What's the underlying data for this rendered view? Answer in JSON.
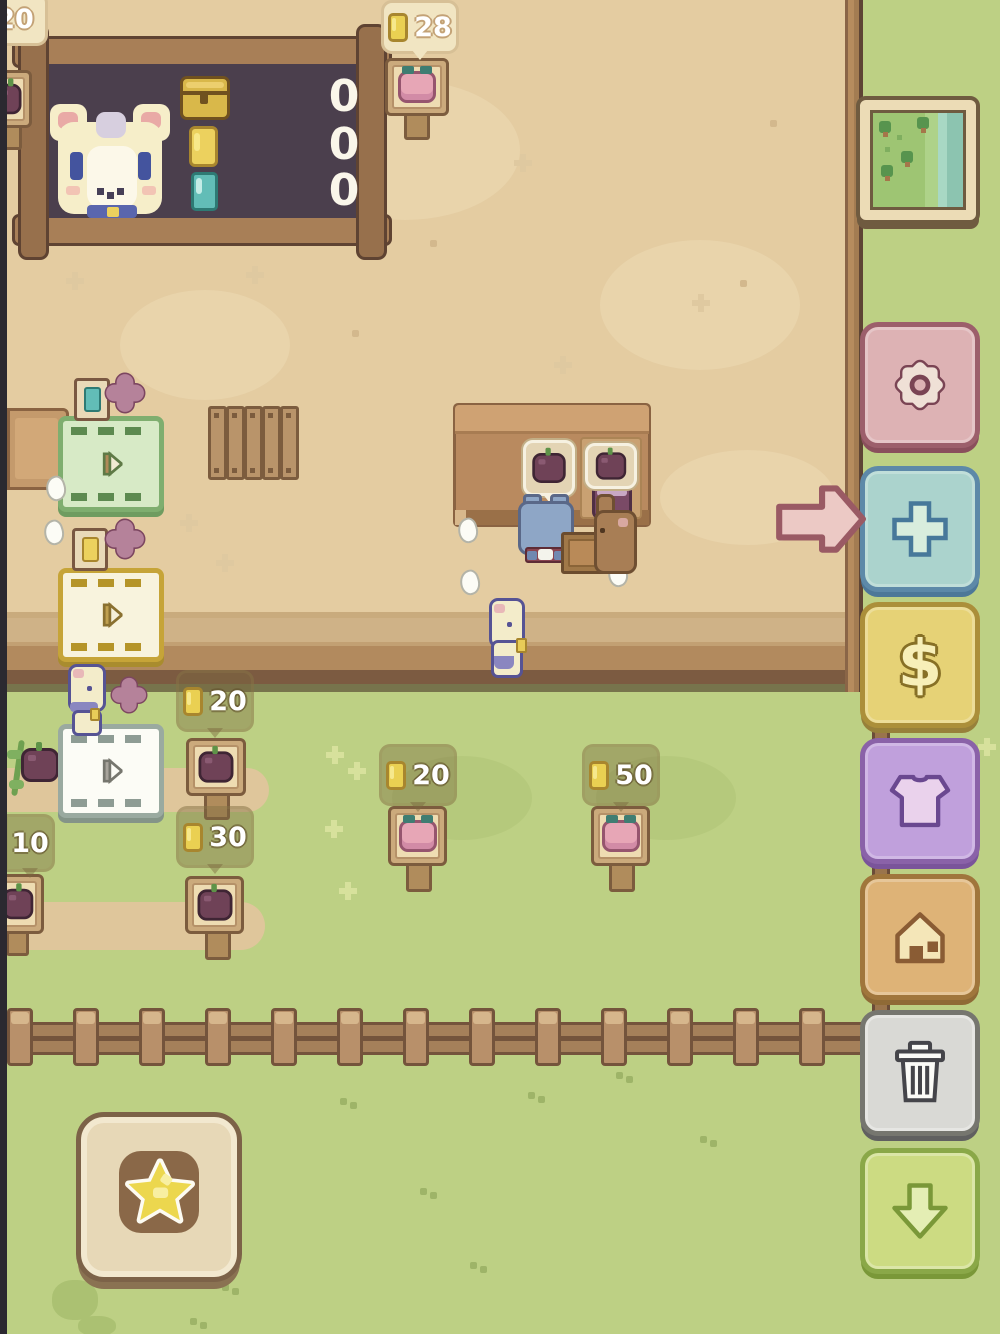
{
  "palette": {
    "grass": "#bdd084",
    "ground": "#e4cca1",
    "wood_band_dark": "#7c5b41",
    "board_bg": "#4b3f4d",
    "settings_pink": "#ddb2b4",
    "add_blue": "#abd3cd",
    "money_yellow": "#e6d276",
    "outfit_purple": "#c0a0dc",
    "home_orange": "#deb377",
    "trash_gray": "#d9d9d5",
    "hide_green": "#ccdb82",
    "pointer_pink": "#ecc9c5",
    "coin_gold": "#ecd15e",
    "gem_teal": "#62bdb7",
    "apple_plum": "#6f4257",
    "peach_pink": "#e7a6b6"
  },
  "scoreboard": {
    "rows": [
      {
        "icon": "treasure-chest-icon",
        "value": "0"
      },
      {
        "icon": "coin-icon",
        "value": "0"
      },
      {
        "icon": "gem-icon",
        "value": "0"
      }
    ]
  },
  "price_tags": {
    "corner": {
      "value": "20"
    },
    "stand_top": {
      "value": "28"
    },
    "belt": {
      "value": "20"
    },
    "field_left": {
      "value": "10"
    },
    "field_mid": {
      "value": "30"
    },
    "grass_left": {
      "value": "20"
    },
    "grass_right": {
      "value": "50"
    }
  },
  "sidebar": {
    "dollar_symbol": "$",
    "buttons": [
      {
        "id": "map",
        "icon": "map-icon"
      },
      {
        "id": "settings",
        "icon": "gear-icon"
      },
      {
        "id": "add",
        "icon": "plus-icon"
      },
      {
        "id": "money",
        "icon": "dollar-icon"
      },
      {
        "id": "outfit",
        "icon": "shirt-icon"
      },
      {
        "id": "home",
        "icon": "house-icon"
      },
      {
        "id": "trash",
        "icon": "trash-icon"
      },
      {
        "id": "hide-ui",
        "icon": "down-arrow-icon"
      }
    ]
  },
  "icons": {
    "star": "gold star medallion",
    "pointer": "pink right arrow",
    "play": "play triangle on dispenser",
    "clover": "four-petal flower",
    "feather": "white feather drop"
  }
}
